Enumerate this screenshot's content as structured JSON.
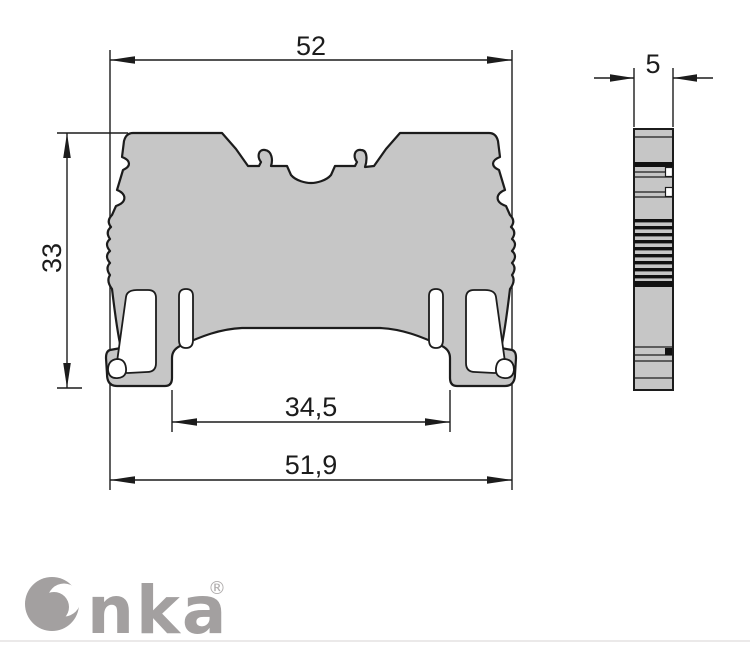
{
  "drawing": {
    "title": "terminal-block-dimension-drawing",
    "front_view": {
      "dim_top_width": "52",
      "dim_height": "33",
      "dim_inner_bottom_width": "34,5",
      "dim_bottom_width": "51,9"
    },
    "side_view": {
      "dim_width": "5"
    }
  },
  "logo": {
    "brand_tail": "nka",
    "registered_mark": "®"
  },
  "colors": {
    "body_fill": "#c6c6c6",
    "tab_fill": "#d3d3d3",
    "outline": "#1c1c1c",
    "logo_gray": "#a3a0a0",
    "divider": "#ebe9e9"
  }
}
